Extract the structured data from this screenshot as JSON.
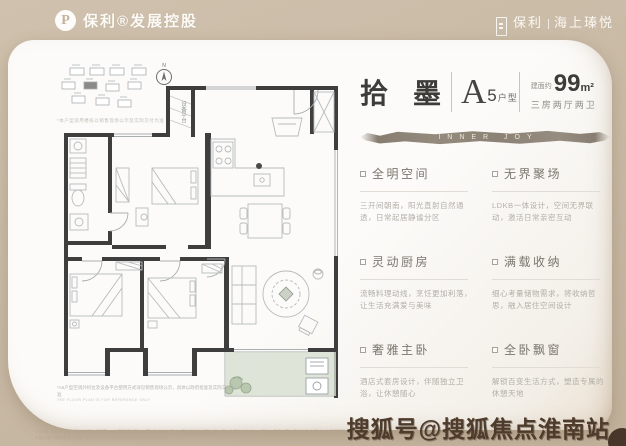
{
  "colors": {
    "background": "#c9baa6",
    "card": "#fcfbf9",
    "wall": "#3e3e3e",
    "balcony_fill": "#d6decf",
    "banner_brush": "#8b8275",
    "watermark_brown": "#4e3b2b"
  },
  "header": {
    "logo_letter": "P",
    "brand_left": "保利®发展控股",
    "brand_right_1": "保利",
    "brand_right_2": "海上瑧悦",
    "brand_right_sub": "· · · · · · ·"
  },
  "title": {
    "name": "拾 墨",
    "unit_letter": "A",
    "unit_number": "5",
    "unit_label": "户型",
    "area_prefix": "建面约",
    "area_number": "99",
    "area_unit": "m²",
    "rooms": "三房两厅两卫",
    "banner_text": "INNER JOY"
  },
  "features": [
    {
      "title": "全明空间",
      "desc": "三开间朝南，阳光直射自然通透，日常起居静谧分区"
    },
    {
      "title": "无界聚场",
      "desc": "LDKB一体设计，空间无界联动，激活日常亲密互动"
    },
    {
      "title": "灵动厨房",
      "desc": "流畅料理动线，烹饪更加利落，让生活充满爱与美味"
    },
    {
      "title": "满载收纳",
      "desc": "细心考量储物需求，将收纳哲思，融入居住空间设计"
    },
    {
      "title": "奢雅主卧",
      "desc": "酒店式套房设计，伴随独立卫浴，让休憩随心"
    },
    {
      "title": "全卧飘窗",
      "desc": "解锁百变生活方式，塑造专属的休憩天地"
    }
  ],
  "floorplan": {
    "equipment_platform_label": "设备平台",
    "compass_label": "N",
    "siteplan_note": "*本户型适用楼栋以销售现场公示及实际交付为准",
    "disclaimer_line1": "*A5户型空调外机位及设备平台使用方式详见销售现场公示，具体以政府批复及实际交付为准",
    "disclaimer_line2": "THE FLOOR PLAN IS FOR REFERENCE ONLY"
  },
  "footer": {
    "disclaimer_line1": "1.本资料为要约邀请，不作为要约或承诺；2.本资料相关图文内容仅供参考，最终以政府批准文件及商品房买卖合同约定为准；3.开发商保留对宣传资料修改的权利，敬请留意最新资料；",
    "disclaimer_line2": "4.部分图片素材来源于网络，具体信息以销售现场及政府最终批复文件为准。",
    "watermark": "搜狐号@搜狐焦点淮南站"
  }
}
